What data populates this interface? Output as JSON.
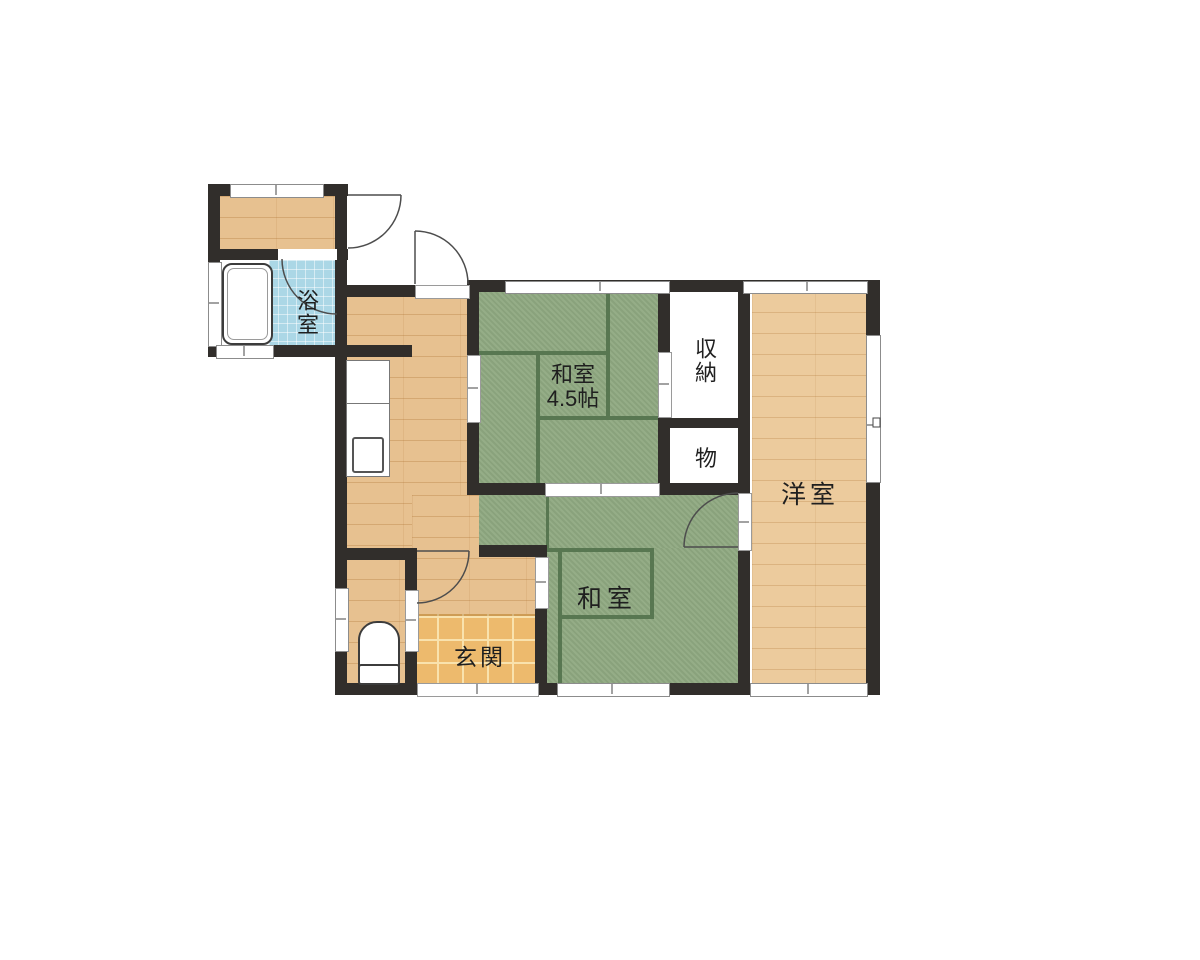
{
  "page_title": "間取り図",
  "rooms": {
    "bathroom": {
      "label": "浴室"
    },
    "japanese_room_45": {
      "label_line1": "和室",
      "label_line2": "4.5帖"
    },
    "storage": {
      "label": "収納"
    },
    "closet": {
      "label": "物"
    },
    "western_room": {
      "label": "洋室"
    },
    "japanese_room": {
      "label": "和室"
    },
    "entrance": {
      "label": "玄関"
    }
  },
  "colors": {
    "wall": "#312e2b",
    "wood": "#e7c190",
    "wood-light": "#eccb9d",
    "tatami": "#8fa981",
    "matline": "#587751",
    "tile": "#edba6d",
    "tile-grout": "#f9e2ad",
    "bath-tile": "#abd7e6",
    "label": "#1f1f1f"
  }
}
